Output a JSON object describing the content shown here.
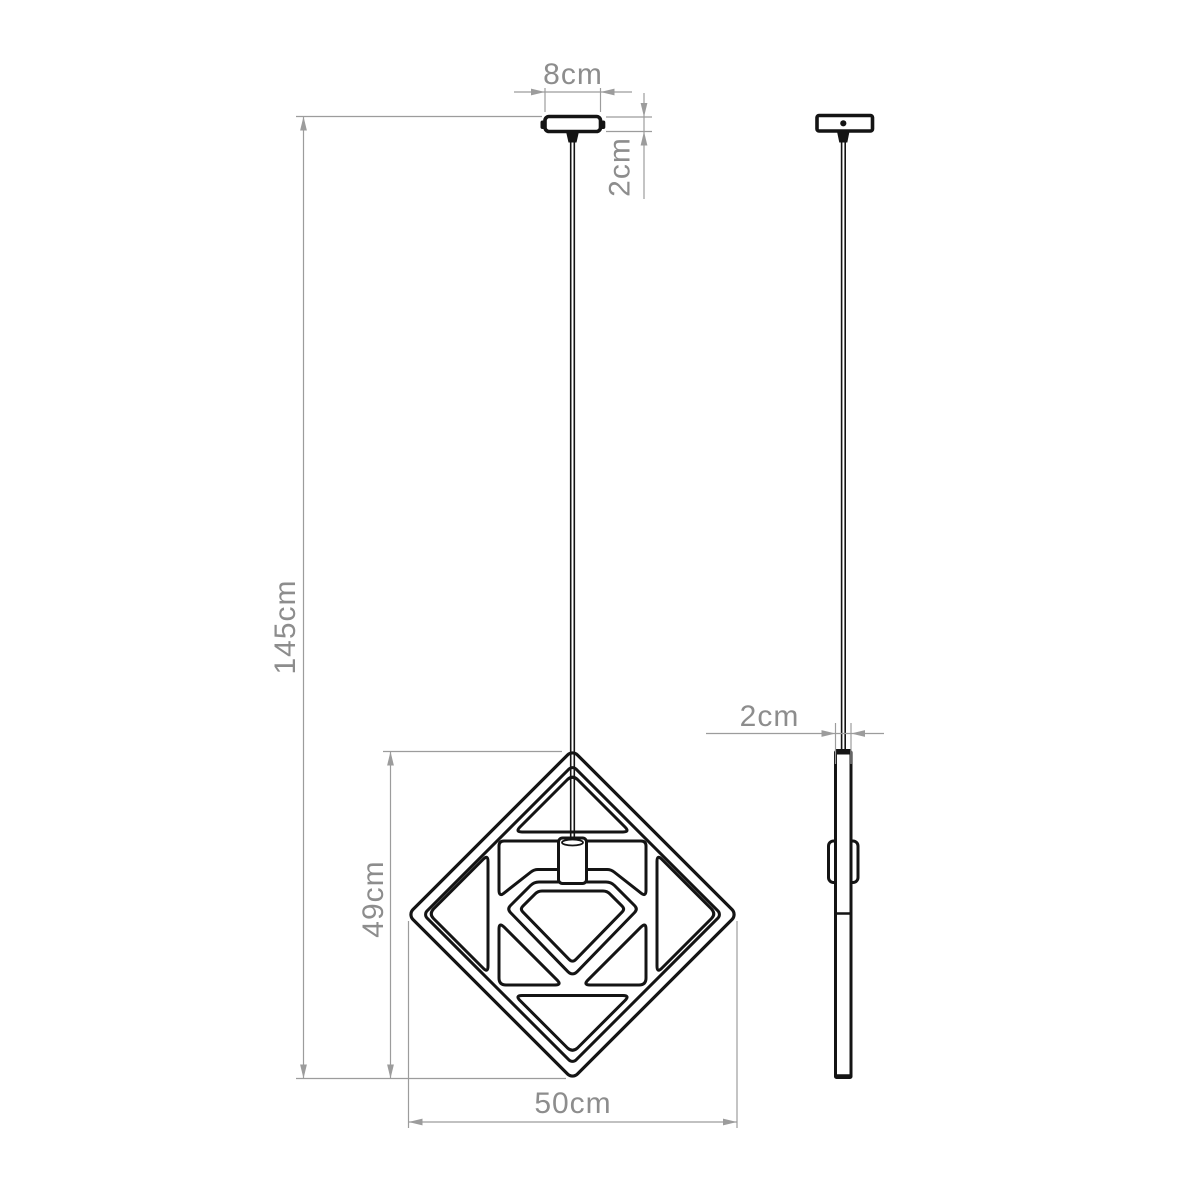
{
  "colors": {
    "outline": "#141414",
    "dimension_line": "#9c9c9c",
    "dimension_text": "#8d8d8d",
    "background": "#ffffff"
  },
  "dims": {
    "canopy_width": "8cm",
    "canopy_height": "2cm",
    "total_drop": "145cm",
    "shade_height": "49cm",
    "shade_width": "50cm",
    "shade_thickness": "2cm"
  }
}
